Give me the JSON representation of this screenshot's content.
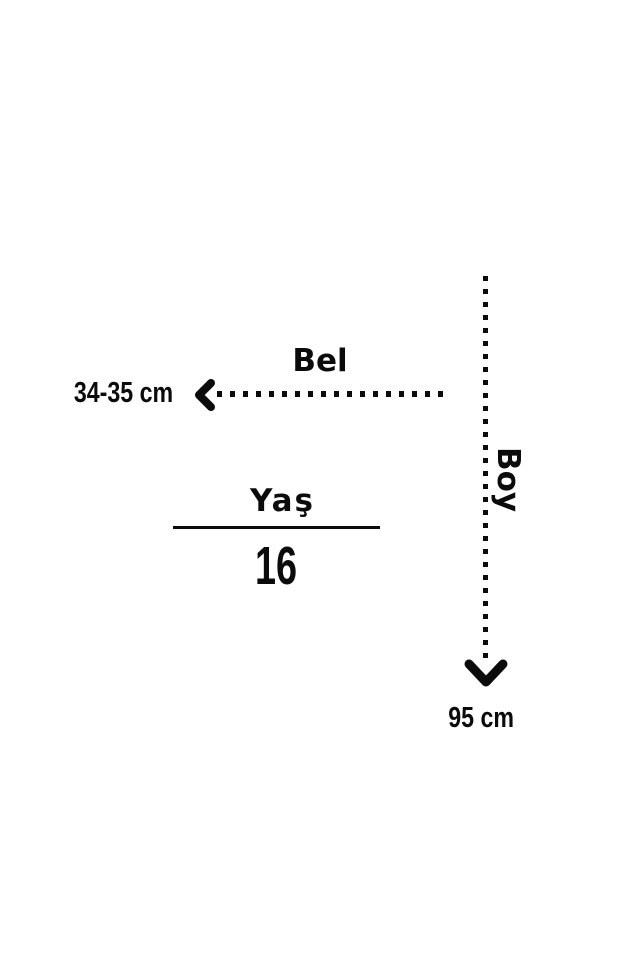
{
  "diagram": {
    "background_color": "#ffffff",
    "ink_color": "#0b0b0b",
    "waist": {
      "label": "Bel",
      "value": "34-35 cm"
    },
    "height": {
      "label": "Boy",
      "value": "95 cm"
    },
    "age": {
      "label": "Yaş",
      "value": "16"
    }
  }
}
